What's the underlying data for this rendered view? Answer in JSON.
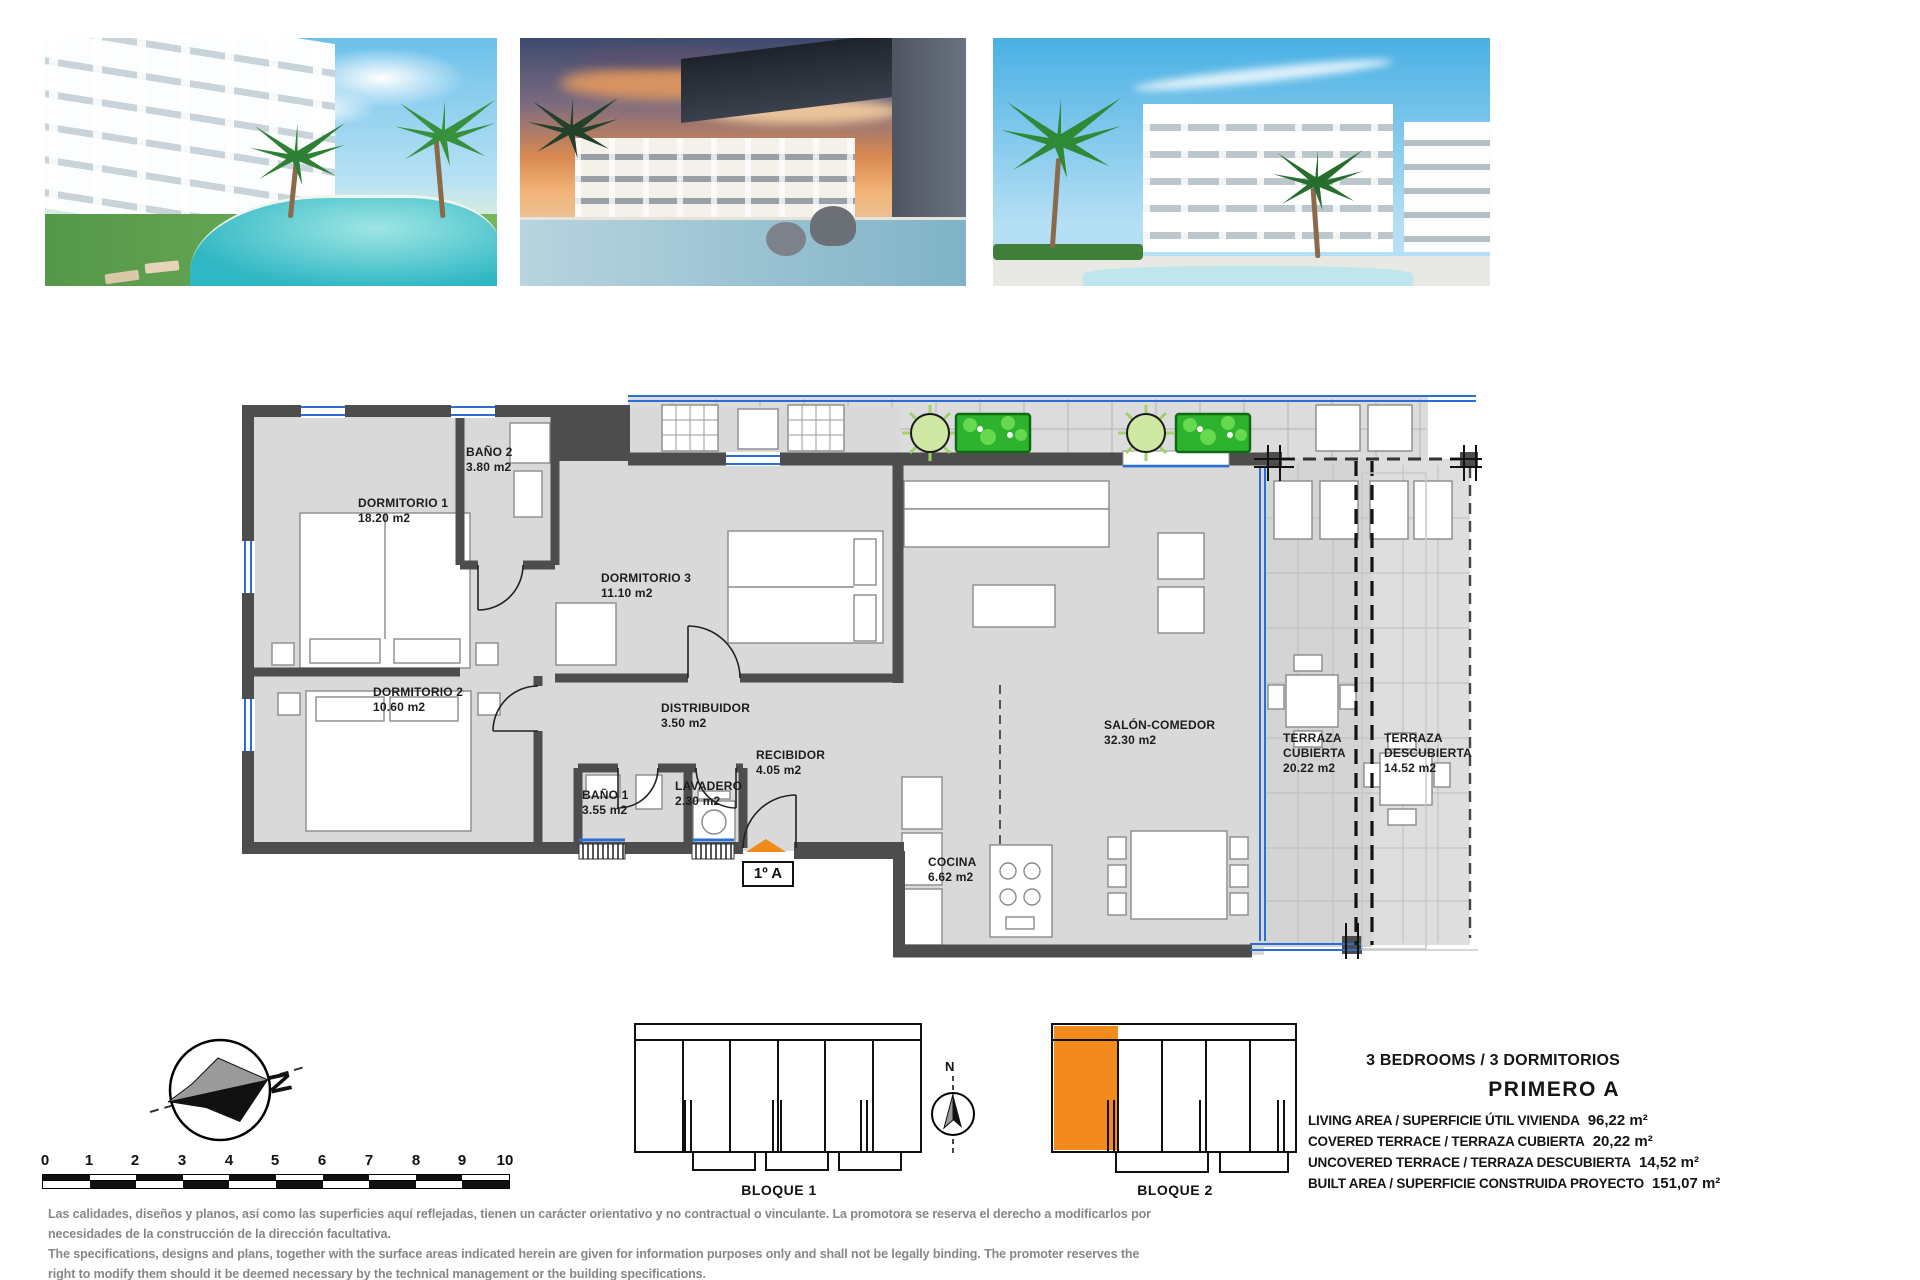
{
  "plan": {
    "unit_badge": "1º A",
    "rooms": [
      {
        "name": "DORMITORIO 1",
        "area": "18.20 m2"
      },
      {
        "name": "BAÑO 2",
        "area": "3.80 m2"
      },
      {
        "name": "DORMITORIO 3",
        "area": "11.10 m2"
      },
      {
        "name": "DORMITORIO 2",
        "area": "10.60 m2"
      },
      {
        "name": "DISTRIBUIDOR",
        "area": "3.50 m2"
      },
      {
        "name": "BAÑO 1",
        "area": "3.55 m2"
      },
      {
        "name": "LAVADERO",
        "area": "2.30 m2"
      },
      {
        "name": "RECIBIDOR",
        "area": "4.05 m2"
      },
      {
        "name": "SALÓN-COMEDOR",
        "area": "32.30 m2"
      },
      {
        "name": "COCINA",
        "area": "6.62 m2"
      },
      {
        "name": "TERRAZA CUBIERTA",
        "area": "20.22 m2"
      },
      {
        "name": "TERRAZA DESCUBIERTA",
        "area": "14.52 m2"
      }
    ]
  },
  "summary": {
    "header": "3 BEDROOMS / 3 DORMITORIOS",
    "unit": "PRIMERO A",
    "rows": [
      {
        "label": "LIVING AREA / SUPERFICIE ÚTIL VIVIENDA",
        "value": "96,22 m²"
      },
      {
        "label": "COVERED TERRACE / TERRAZA CUBIERTA",
        "value": "20,22 m²"
      },
      {
        "label": "UNCOVERED TERRACE / TERRAZA DESCUBIERTA",
        "value": "14,52 m²"
      },
      {
        "label": "BUILT AREA / SUPERFICIE CONSTRUIDA PROYECTO",
        "value": "151,07 m²"
      }
    ]
  },
  "blocks": {
    "block1": "BLOQUE 1",
    "block2": "BLOQUE 2"
  },
  "compass": {
    "north": "N"
  },
  "scalebar": {
    "ticks": [
      "0",
      "1",
      "2",
      "3",
      "4",
      "5",
      "6",
      "7",
      "8",
      "9",
      "10"
    ]
  },
  "disclaimer": {
    "es1": "Las calidades, diseños y planos, así como las superficies aquí reflejadas, tienen un carácter orientativo y no contractual o vinculante. La promotora se reserva el derecho a modificarlos por",
    "es2": "necesidades de la construcción de la dirección facultativa.",
    "en1": "The specifications, designs and plans, together with the surface areas indicated herein are given for information purposes only and shall not be legally binding. The promoter reserves the",
    "en2": "right to modify them should it be deemed necessary by the technical management or the building specifications."
  },
  "colors": {
    "accent_orange": "#F08A1A",
    "window_blue": "#2a6fd6",
    "wall_gray": "#4d4d4d",
    "plant_green": "#2db32d"
  }
}
